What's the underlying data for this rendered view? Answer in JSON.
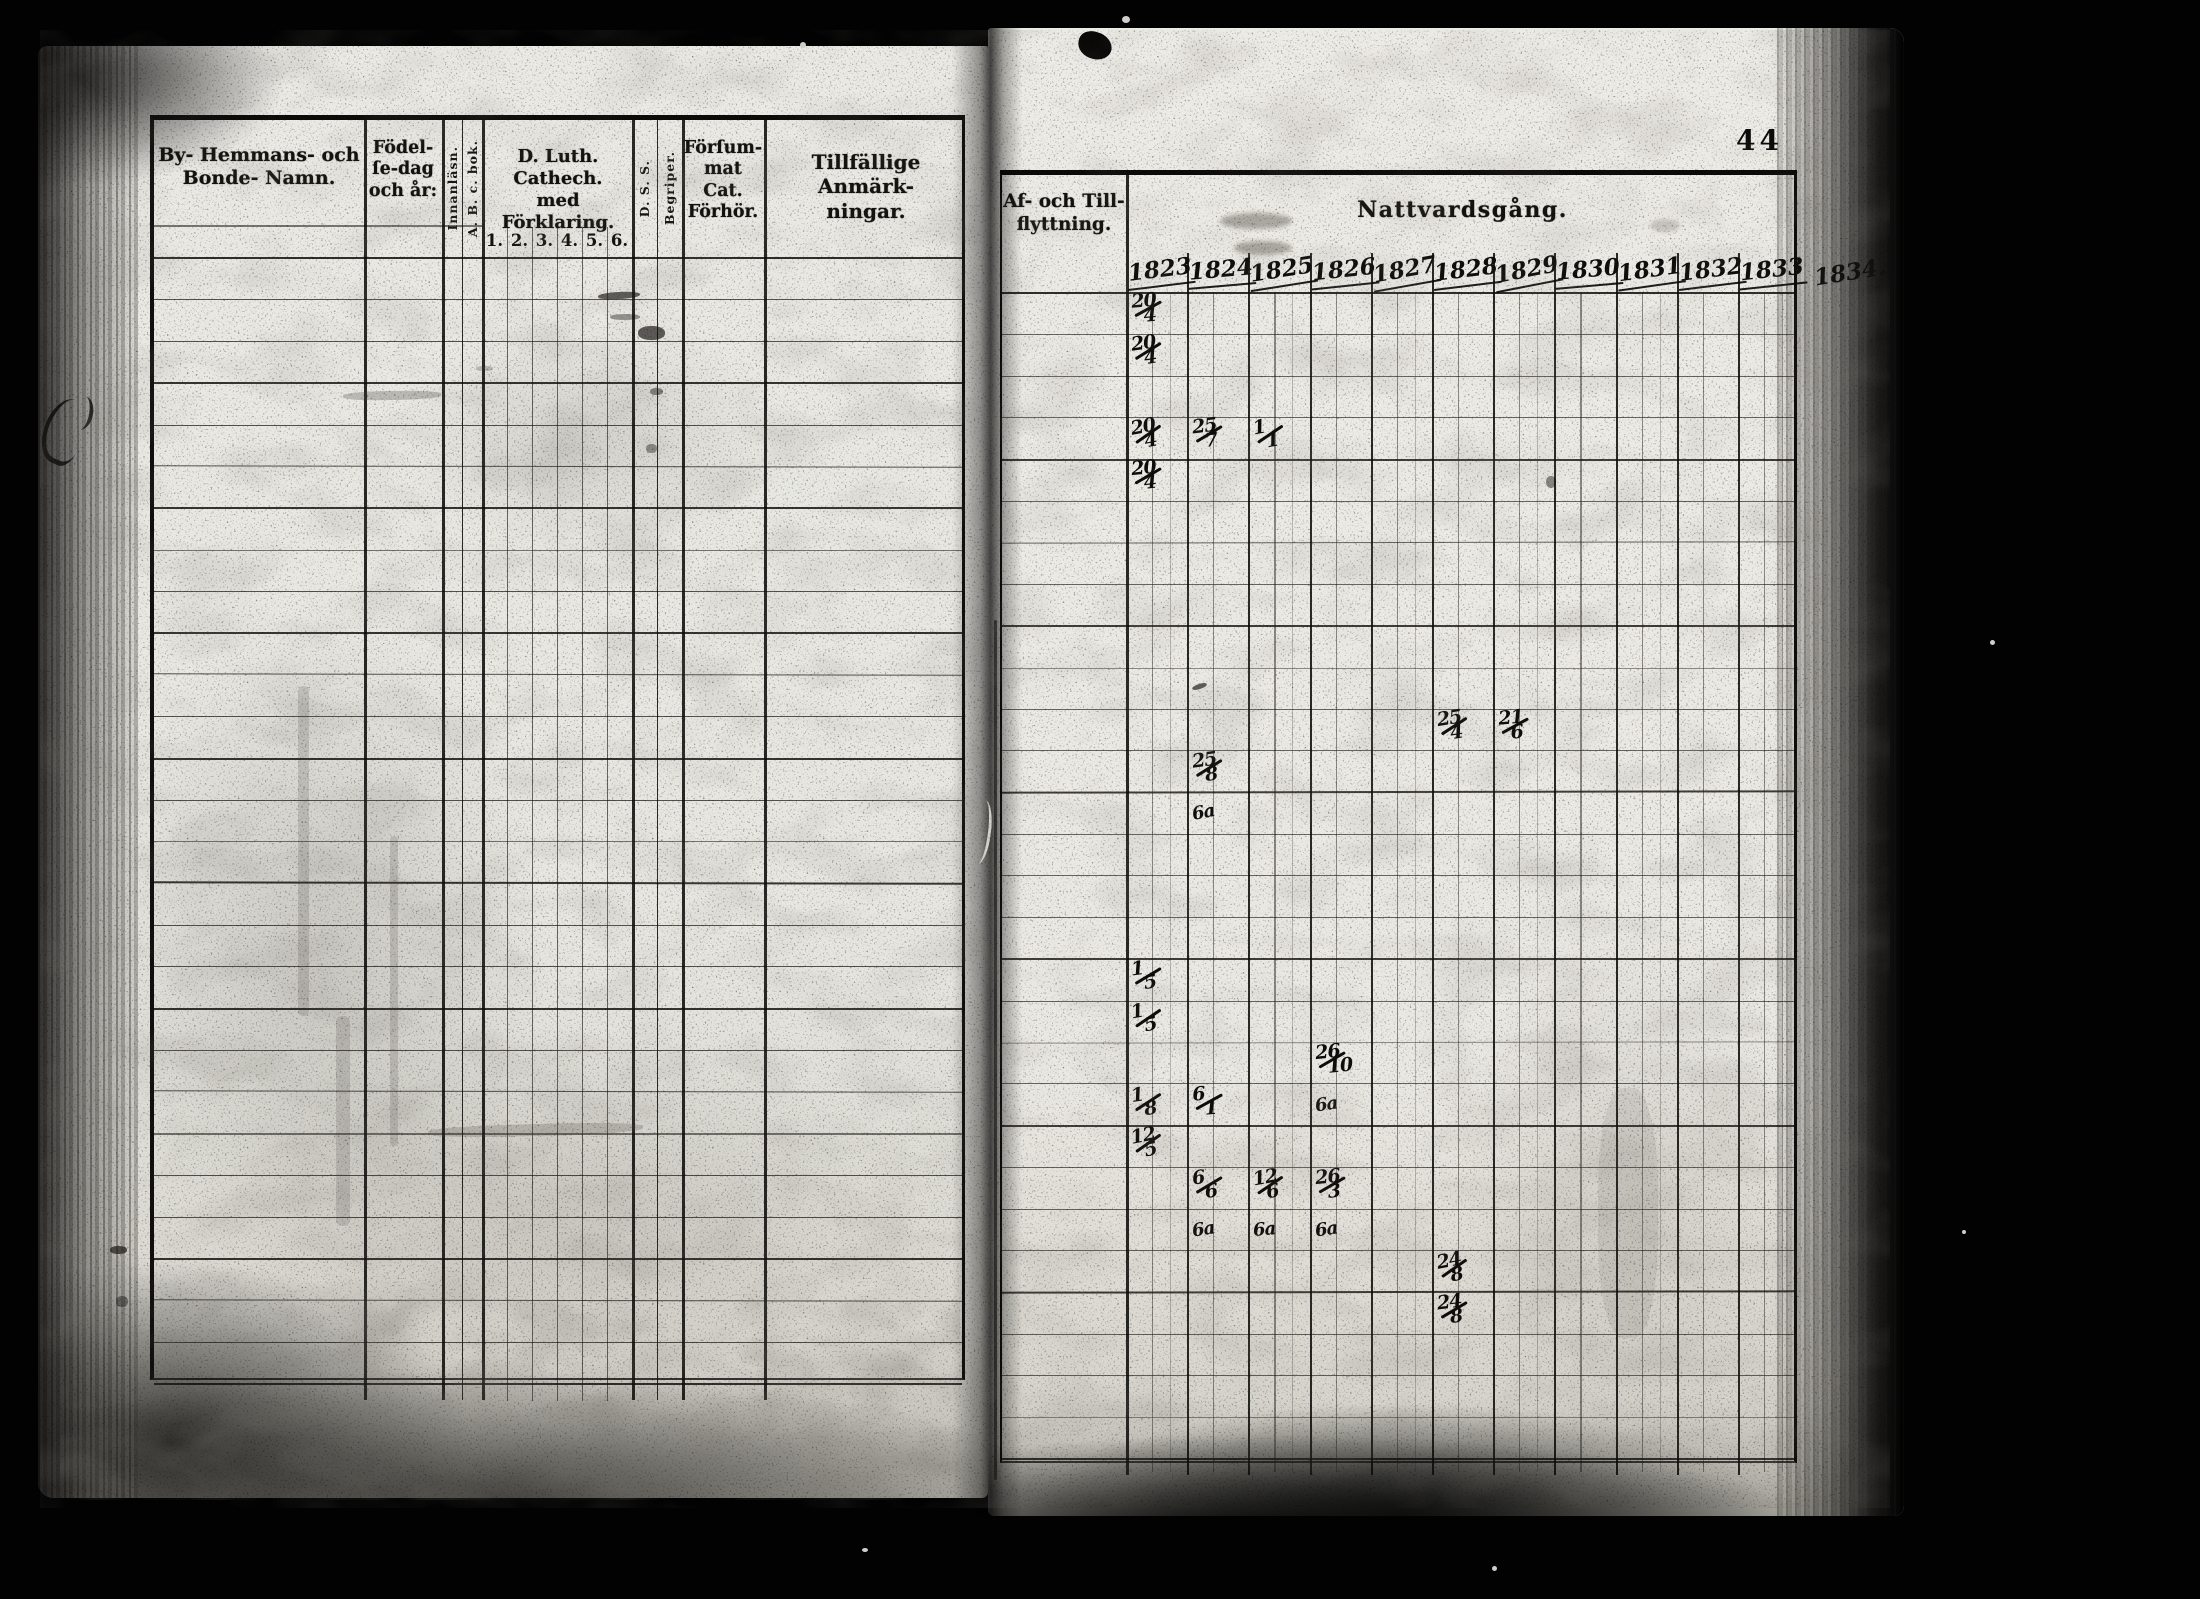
{
  "page_number": "44",
  "left_table": {
    "headers": {
      "name": "By- Hemmans- och\nBonde- Namn.",
      "birth": "Födel-\nſe-dag\noch år:",
      "innanlasn": "Innanläsn.",
      "abc_bok": "A. B. c. bok.",
      "cathech": "D. Luth. Cathech.\nmed Förklaring.",
      "dss": "D. S. S.",
      "begriper": "Begriper.",
      "forsummat": "Förſum-\nmat Cat.\nFörhör.",
      "anmarkningar": "Tillfällige Anmärk-\nningar."
    },
    "subcolumns": [
      "1.",
      "2.",
      "3.",
      "4.",
      "5.",
      "6."
    ],
    "row_count": 27
  },
  "right_table": {
    "headers": {
      "flyttning": "Af- och Till-\nflyttning.",
      "nattvardsgang": "Nattvardsgång."
    },
    "years": [
      "1823",
      "1824",
      "1825",
      "1826",
      "1827",
      "1828",
      "1829",
      "1830",
      "1831",
      "1832",
      "1833"
    ],
    "year_outside": "1834.",
    "row_count": 28,
    "entries": [
      {
        "row": 1,
        "year": "1823",
        "num": "20",
        "den": "4"
      },
      {
        "row": 2,
        "year": "1823",
        "num": "20",
        "den": "4"
      },
      {
        "row": 4,
        "year": "1823",
        "num": "20",
        "den": "4"
      },
      {
        "row": 4,
        "year": "1824",
        "num": "25",
        "den": "7"
      },
      {
        "row": 4,
        "year": "1825",
        "num": "1",
        "den": "1"
      },
      {
        "row": 5,
        "year": "1823",
        "num": "20",
        "den": "4"
      },
      {
        "row": 11,
        "year": "1828",
        "num": "25",
        "den": "4"
      },
      {
        "row": 11,
        "year": "1829",
        "num": "21",
        "den": "6"
      },
      {
        "row": 12,
        "year": "1824",
        "num": "25",
        "den": "8"
      },
      {
        "row": 13,
        "year": "1824",
        "text": "6a"
      },
      {
        "row": 17,
        "year": "1823",
        "num": "1",
        "den": "5"
      },
      {
        "row": 18,
        "year": "1823",
        "num": "1",
        "den": "5"
      },
      {
        "row": 19,
        "year": "1826",
        "num": "26",
        "den": "10"
      },
      {
        "row": 20,
        "year": "1823",
        "num": "1",
        "den": "8"
      },
      {
        "row": 20,
        "year": "1824",
        "num": "6",
        "den": "1"
      },
      {
        "row": 20,
        "year": "1826",
        "text": "6a"
      },
      {
        "row": 21,
        "year": "1823",
        "num": "12",
        "den": "5"
      },
      {
        "row": 22,
        "year": "1824",
        "num": "6",
        "den": "6"
      },
      {
        "row": 22,
        "year": "1825",
        "num": "12",
        "den": "6"
      },
      {
        "row": 22,
        "year": "1826",
        "num": "26",
        "den": "3"
      },
      {
        "row": 23,
        "year": "1824",
        "text": "6a"
      },
      {
        "row": 23,
        "year": "1825",
        "text": "6a"
      },
      {
        "row": 23,
        "year": "1826",
        "text": "6a"
      },
      {
        "row": 24,
        "year": "1828",
        "num": "24",
        "den": "8"
      },
      {
        "row": 25,
        "year": "1828",
        "num": "24",
        "den": "8"
      }
    ]
  }
}
